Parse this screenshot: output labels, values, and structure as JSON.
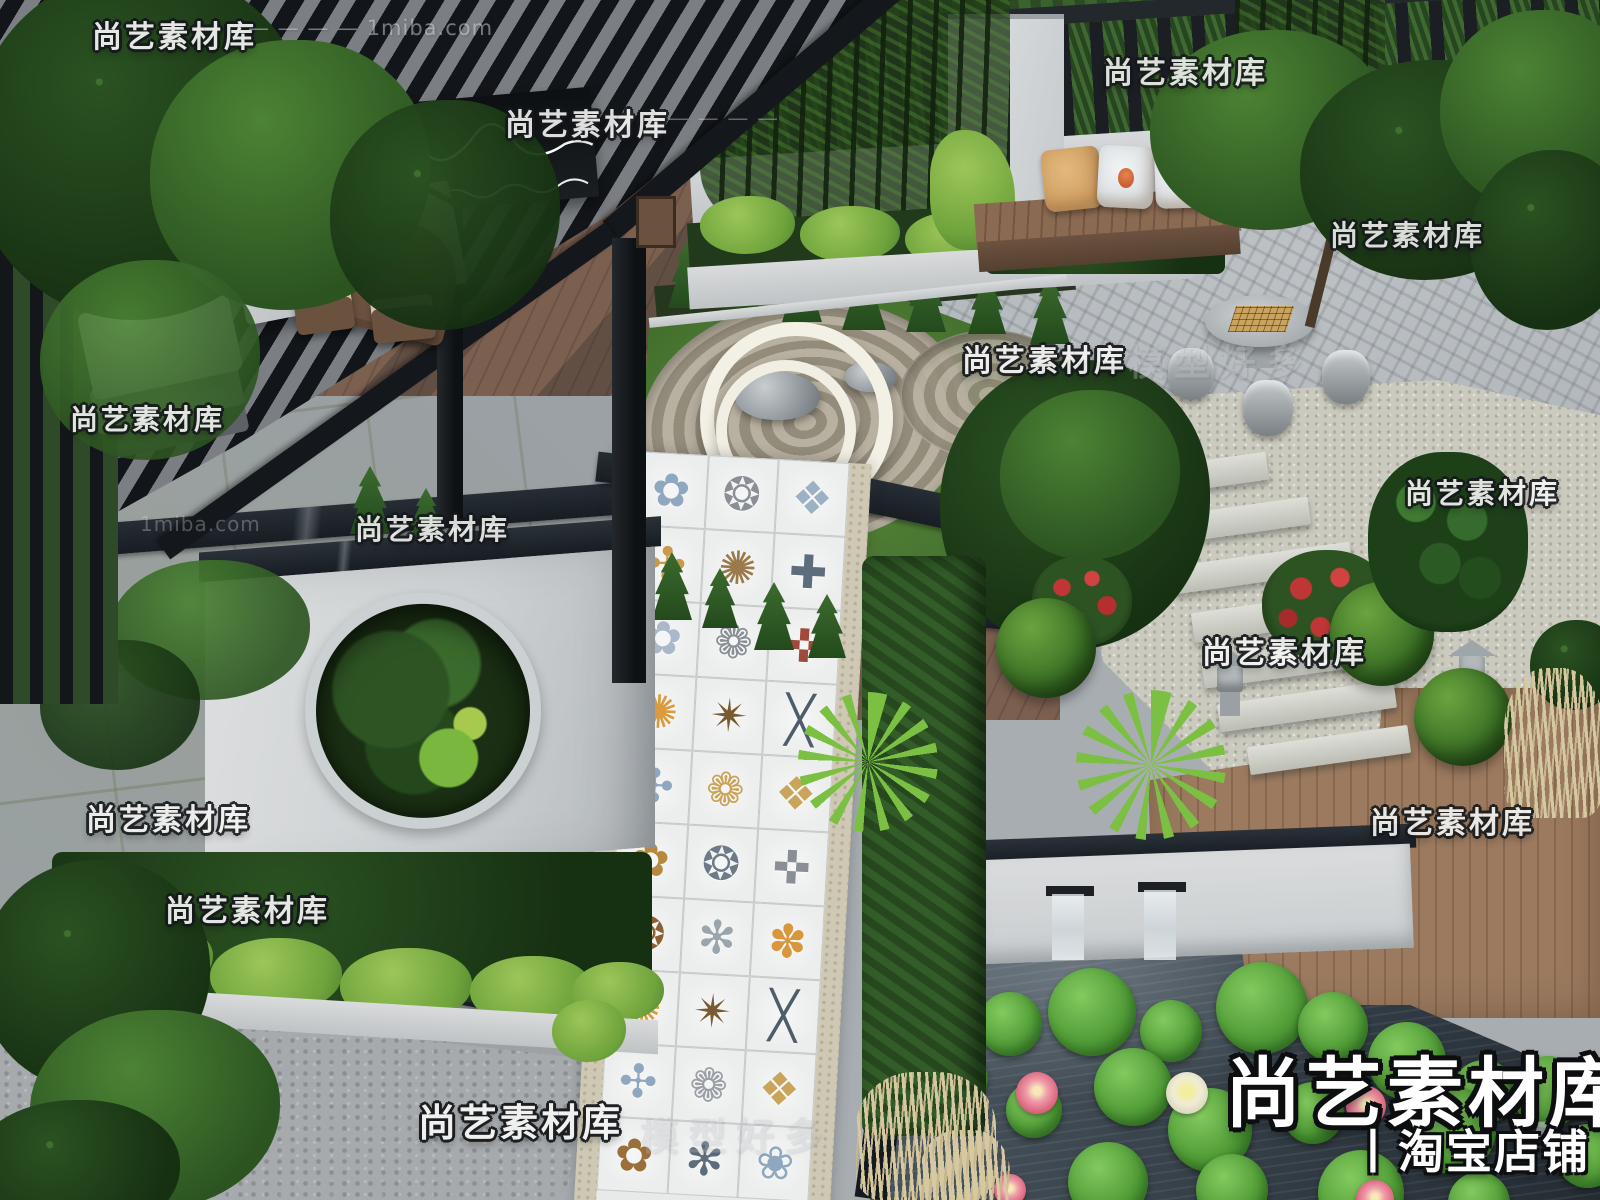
{
  "brand": {
    "title": "尚艺素材库",
    "subtitle": "丨淘宝店铺",
    "subtitle_suffix": "7"
  },
  "watermark_text": "尚艺素材库",
  "ghost_watermark_text": "模型好多",
  "domain_watermark_text": "1miba.com",
  "watermarks": [
    {
      "t": "尚艺素材库",
      "kind": "main",
      "x": 92,
      "y": 12,
      "s": 30,
      "o": 0.93
    },
    {
      "t": "— — — — 1miba.com",
      "kind": "domain",
      "x": 248,
      "y": 16,
      "s": 21,
      "o": 0.5
    },
    {
      "t": "尚艺素材库",
      "kind": "main",
      "x": 505,
      "y": 100,
      "s": 30,
      "o": 0.9
    },
    {
      "t": "— — — —",
      "kind": "domain",
      "x": 668,
      "y": 106,
      "s": 21,
      "o": 0.4
    },
    {
      "t": "尚艺素材库",
      "kind": "main",
      "x": 1103,
      "y": 48,
      "s": 30,
      "o": 0.88
    },
    {
      "t": "尚艺素材库",
      "kind": "main",
      "x": 70,
      "y": 398,
      "s": 28,
      "o": 0.9
    },
    {
      "t": "尚艺素材库",
      "kind": "main",
      "x": 355,
      "y": 508,
      "s": 28,
      "o": 0.88
    },
    {
      "t": "1miba.com",
      "kind": "domain",
      "x": 140,
      "y": 512,
      "s": 20,
      "o": 0.32
    },
    {
      "t": "尚艺素材库",
      "kind": "main",
      "x": 86,
      "y": 795,
      "s": 30,
      "o": 0.9
    },
    {
      "t": "尚艺素材库",
      "kind": "main",
      "x": 165,
      "y": 886,
      "s": 30,
      "o": 0.92
    },
    {
      "t": "尚艺素材库",
      "kind": "main",
      "x": 962,
      "y": 336,
      "s": 30,
      "o": 0.92
    },
    {
      "t": "模型好多",
      "kind": "ghost",
      "x": 1128,
      "y": 334,
      "s": 36,
      "o": 0.35
    },
    {
      "t": "尚艺素材库",
      "kind": "main",
      "x": 1330,
      "y": 214,
      "s": 28,
      "o": 0.88
    },
    {
      "t": "尚艺素材库",
      "kind": "main",
      "x": 1405,
      "y": 472,
      "s": 28,
      "o": 0.9
    },
    {
      "t": "尚艺素材库",
      "kind": "main",
      "x": 1202,
      "y": 628,
      "s": 30,
      "o": 0.92
    },
    {
      "t": "尚艺素材库",
      "kind": "main",
      "x": 1370,
      "y": 798,
      "s": 30,
      "o": 0.9
    },
    {
      "t": "尚艺素材库",
      "kind": "main",
      "x": 418,
      "y": 1092,
      "s": 38,
      "o": 0.95
    },
    {
      "t": "模型好多",
      "kind": "ghost",
      "x": 640,
      "y": 1106,
      "s": 38,
      "o": 0.28
    }
  ],
  "tile_path": {
    "rows": [
      [
        {
          "g": "✿",
          "c": "#8fa7bf"
        },
        {
          "g": "❂",
          "c": "#8a8f96"
        },
        {
          "g": "❖",
          "c": "#9db1c4"
        }
      ],
      [
        {
          "g": "✣",
          "c": "#c99a4a"
        },
        {
          "g": "✺",
          "c": "#9a7a4a"
        },
        {
          "g": "✚",
          "c": "#5d6d7c"
        }
      ],
      [
        {
          "g": "✿",
          "c": "#a9b9c9"
        },
        {
          "g": "❁",
          "c": "#8a8f96"
        },
        {
          "g": "✜",
          "c": "#a04a3c"
        }
      ],
      [
        {
          "g": "✺",
          "c": "#d99b3d"
        },
        {
          "g": "✴",
          "c": "#7a5a30"
        },
        {
          "g": "╳",
          "c": "#4e5d6c"
        }
      ],
      [
        {
          "g": "✣",
          "c": "#8fa7bf"
        },
        {
          "g": "❁",
          "c": "#c9a45a"
        },
        {
          "g": "❖",
          "c": "#c9a45a"
        }
      ],
      [
        {
          "g": "✿",
          "c": "#b58a3e"
        },
        {
          "g": "❂",
          "c": "#6d7b88"
        },
        {
          "g": "✜",
          "c": "#8a8f96"
        }
      ],
      [
        {
          "g": "❂",
          "c": "#8a6134"
        },
        {
          "g": "✻",
          "c": "#9aa5ad"
        },
        {
          "g": "✽",
          "c": "#d9973d"
        }
      ],
      [
        {
          "g": "✺",
          "c": "#d99b3d"
        },
        {
          "g": "✴",
          "c": "#7a5a30"
        },
        {
          "g": "╳",
          "c": "#4e5d6c"
        }
      ],
      [
        {
          "g": "✣",
          "c": "#8fa7bf"
        },
        {
          "g": "❁",
          "c": "#9aa0a6"
        },
        {
          "g": "❖",
          "c": "#c9a45a"
        }
      ],
      [
        {
          "g": "✿",
          "c": "#9a6f3a"
        },
        {
          "g": "✻",
          "c": "#5d6d7c"
        },
        {
          "g": "❀",
          "c": "#8fa7bf"
        }
      ]
    ]
  },
  "colors": {
    "watermark_white": "#f4f4f3",
    "ghost_gray": "#b9bec2",
    "pergola_black": "#14171b",
    "deck_wood": "#7b6050",
    "pond_water": "#39434c",
    "lotus_leaf": "#4f9a36",
    "lotus_pink": "#d9607a",
    "moon_wall_white": "#d5d8da",
    "stone_band_dark": "#1c2228",
    "tile_amber": "#d99b3d",
    "tile_blue": "#8fa7bf"
  }
}
